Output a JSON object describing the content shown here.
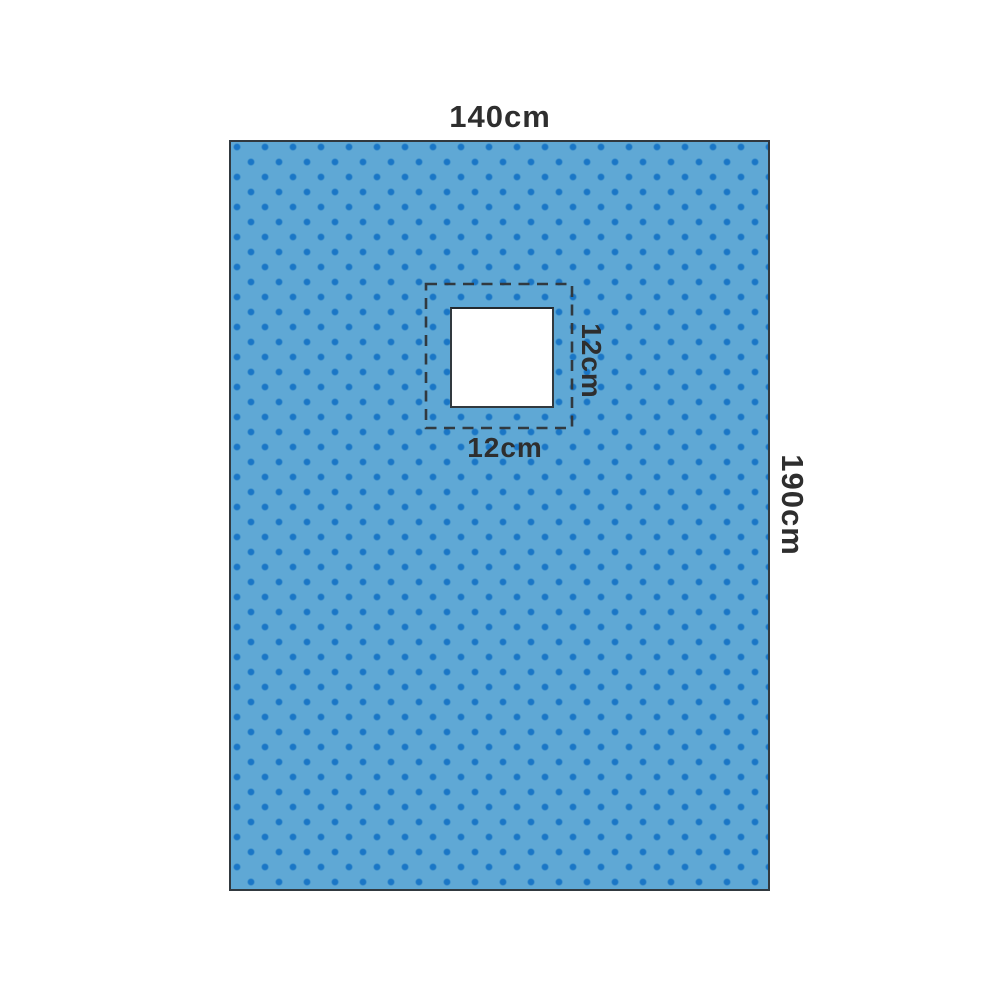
{
  "diagram": {
    "drape_width_label": "140cm",
    "drape_height_label": "190cm",
    "fenestration_width_label": "12cm",
    "fenestration_height_label": "12cm"
  },
  "colors": {
    "drape_fill": "#5FA8D5",
    "dot": "#1A76C6",
    "outline": "#31393F",
    "label_text": "#2E2E2E"
  }
}
